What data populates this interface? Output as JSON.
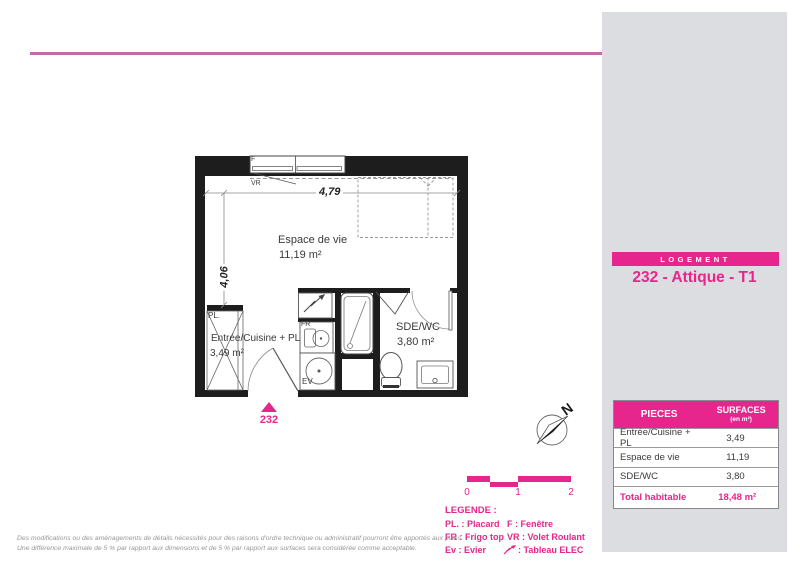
{
  "colors": {
    "accent_pink": "#E6268C",
    "rule_pink": "#C468A8",
    "panel_gray": "#DBDDE0",
    "wall_black": "#1d1d1d"
  },
  "plan": {
    "unit_number": "232",
    "dim_width": "4,79",
    "dim_height": "4,06",
    "rooms": {
      "living": {
        "name": "Espace de vie",
        "area": "11,19 m²"
      },
      "entry": {
        "name": "Entrée/Cuisine + PL",
        "area": "3,49 m²"
      },
      "bath": {
        "name": "SDE/WC",
        "area": "3,80 m²"
      }
    },
    "labels": {
      "window": "F",
      "shutter": "VR",
      "closet": "PL.",
      "fridge": "FR",
      "sink": "EV"
    }
  },
  "compass": {
    "north": "N"
  },
  "scale_bar": {
    "ticks": [
      "0",
      "1",
      "2"
    ]
  },
  "side_panel": {
    "section_label": "LOGEMENT",
    "unit_title": "232 - Attique - T1",
    "table": {
      "col_room": "PIECES",
      "col_surface": "SURFACES",
      "col_surface_unit": "(en m²)",
      "rows": [
        {
          "name": "Entrée/Cuisine + PL",
          "value": "3,49"
        },
        {
          "name": "Espace de vie",
          "value": "11,19"
        },
        {
          "name": "SDE/WC",
          "value": "3,80"
        }
      ],
      "total": {
        "name": "Total habitable",
        "value": "18,48 m²"
      }
    }
  },
  "legend": {
    "title": "LEGENDE :",
    "col1": [
      "PL. : Placard",
      "FR : Frigo top",
      "Ev : Evier"
    ],
    "col2": [
      "F : Fenêtre",
      "VR : Volet Roulant",
      ": Tableau ELEC"
    ]
  },
  "disclaimer": {
    "line1": "Des modifications ou des aménagements de détails nécessités pour des raisons d'ordre technique ou administratif pourront être apportés aux plans",
    "line2": "Une différence maximale de 5 % par rapport aux dimensions et de 5 % par rapport aux surfaces sera considérée comme acceptable."
  }
}
